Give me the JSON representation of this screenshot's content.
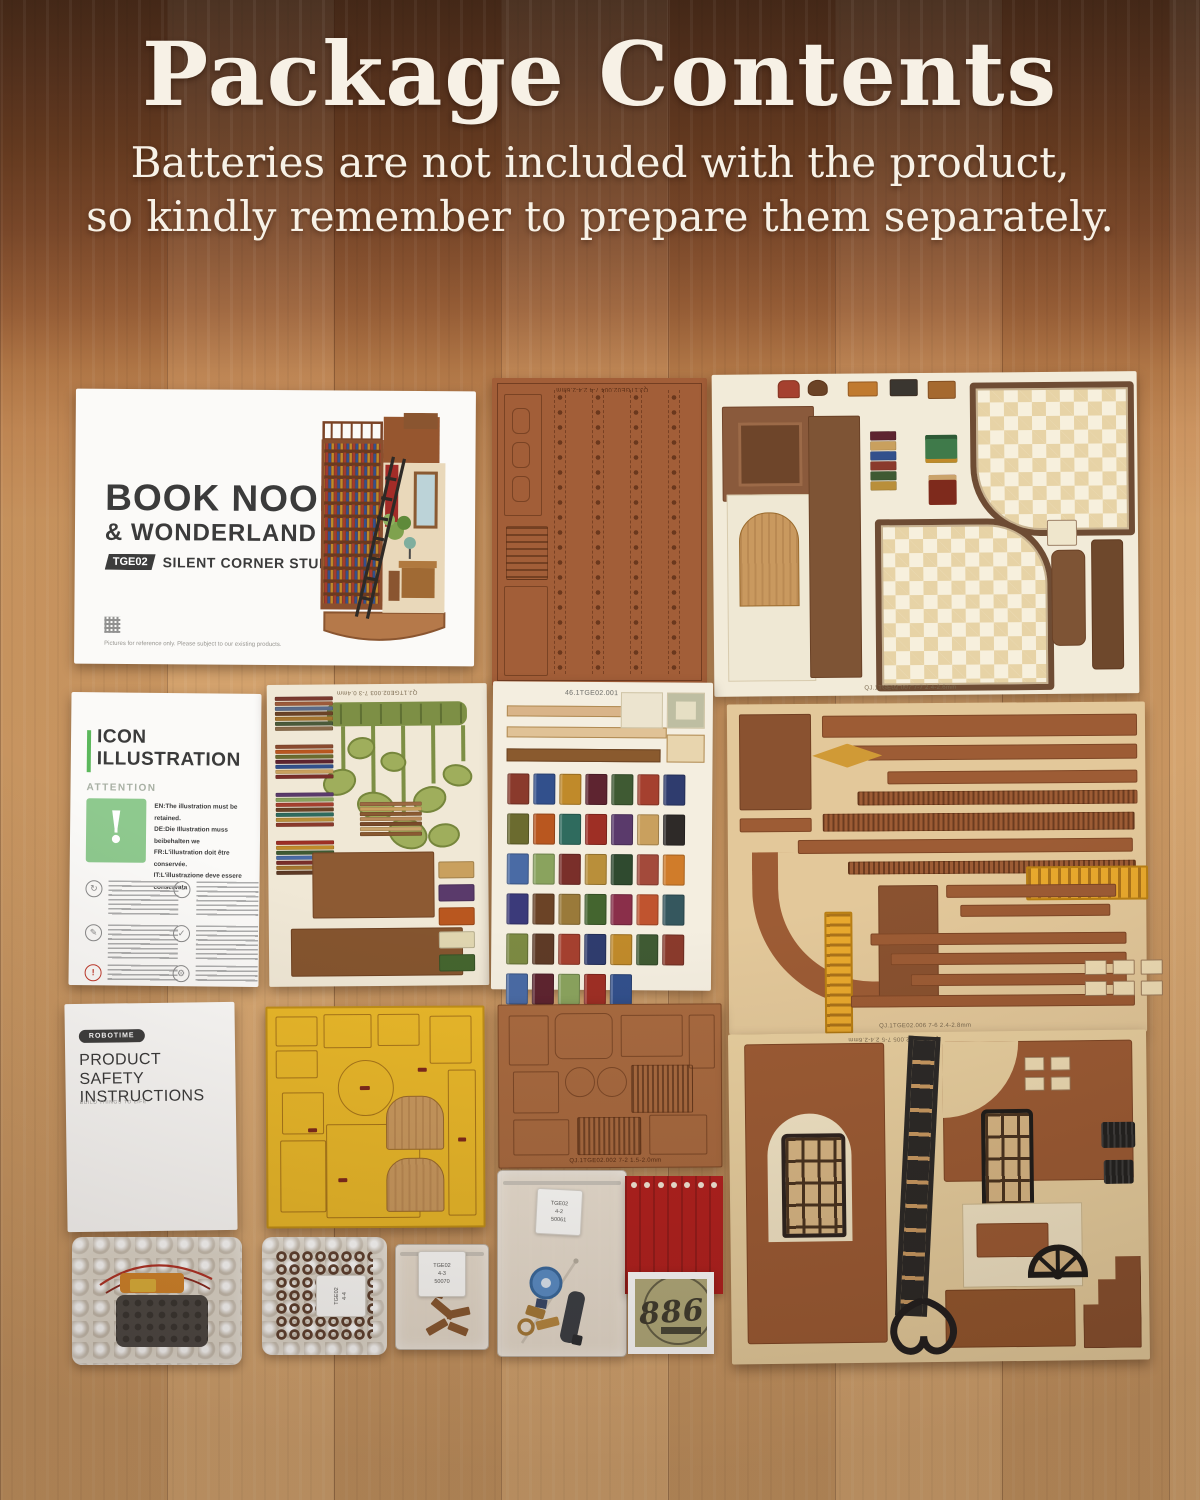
{
  "header": {
    "title": "Package Contents",
    "subtitle_line1": "Batteries are not included with the product,",
    "subtitle_line2": "so kindly remember to prepare them separately."
  },
  "booklet": {
    "title_line1": "BOOK NOOK",
    "title_line2": "& WONDERLAND",
    "model_badge": "TGE02",
    "subtitle": "SILENT CORNER STUDY",
    "fine_print": "Pictures for reference only. Please subject to our existing products."
  },
  "icon_sheet": {
    "title_line1": "ICON",
    "title_line2": "ILLUSTRATION",
    "attention_label": "ATTENTION",
    "attention_mark": "!",
    "notes": [
      "EN:The illustration must be retained.",
      "DE:Die Illustration muss beibehalten we",
      "FR:L'illustration doit être conservée.",
      "IT:L'illustrazione deve essere conservata"
    ],
    "icon_glyphs": {
      "perspective": "↻",
      "tips": "✎",
      "special": "!",
      "glue": "◔",
      "check": "✓",
      "gears": "⚙"
    }
  },
  "safety_sheet": {
    "brand": "ROBOTIME",
    "title_line1": "PRODUCT",
    "title_line2": "SAFETY INSTRUCTIONS",
    "tagline": "BUILD THINGS TO LIFE"
  },
  "sheet_labels": {
    "top_mid": "QJ.1TGE02.004 7-4 2.4-2.6mm",
    "top_right": "QJ.1TGE02.007 7-7 2.4-2.6mm",
    "plant": "QJ.1TGE02.003 7-3 0.4mm",
    "book_stickers": "46.1TGE02.001",
    "mid_right": "QJ.1TGE02.006 7-6 2.4-2.8mm",
    "small_brown": "QJ.1TGE02.002 7-2 1.5-2.0mm",
    "bottom_right": "QJ.1TGE02.005 7-5 2.4-2.6mm"
  },
  "bags": {
    "bag2_label_lines": [
      "TGE02",
      "4-4"
    ],
    "bag3_label_lines": [
      "TGE02",
      "4-3",
      "50070"
    ],
    "bag4_label_lines": [
      "TGE02",
      "4-2",
      "50061"
    ]
  },
  "sticker": {
    "number": "886"
  },
  "colors": {
    "wood_light": "#d2a069",
    "wood_dark": "#3f2516",
    "sheet_brown": "#a25e38",
    "sheet_tan": "#e3c89a",
    "sheet_cream": "#f2ebd9",
    "yellow_sheet": "#e9b82a",
    "railing_gold": "#e9a92d",
    "fabric_red": "#b2211f",
    "attention_green": "#8ec98e",
    "badge_dark": "#3c3c3c",
    "ladder_black": "#2c2a28"
  },
  "books": {
    "palette": [
      "#8a3a2c",
      "#32508c",
      "#c08a2a",
      "#5e2430",
      "#3f5a33",
      "#a5402f",
      "#2f3c6e",
      "#6b6b2f",
      "#b9571f",
      "#2f6b5e",
      "#9e2f25",
      "#5a3a6b",
      "#c9a05e",
      "#2e2a28",
      "#4a6ba5",
      "#8aa35e",
      "#7a2f2a",
      "#b98f3a",
      "#2f4a2f",
      "#a34a3b",
      "#d07c2a",
      "#3b3a7a",
      "#6b4326",
      "#9a7a3a",
      "#44652f",
      "#8a2f4a",
      "#c0542f",
      "#35575e",
      "#7c8a42",
      "#5e3a26",
      "#a5402f",
      "#2f3c6e",
      "#c08a2a",
      "#3f5a33",
      "#8a3a2c",
      "#4a6ba5",
      "#5e2430",
      "#8aa35e",
      "#9e2f25",
      "#32508c"
    ]
  },
  "stacks": {
    "s1": [
      "#7a3a2f",
      "#9c5a3a",
      "#5a6b8a",
      "#6b4326",
      "#a5752f",
      "#4a5a3a",
      "#8a6b4a"
    ],
    "s2": [
      "#8a4a2f",
      "#b9571f",
      "#6b6b2f",
      "#5e2430",
      "#32508c",
      "#c9a05e",
      "#7a2f2a"
    ],
    "s3": [
      "#5a3a6b",
      "#8aa35e",
      "#a5402f",
      "#6b4326",
      "#2f6b5e",
      "#b98f3a",
      "#8a3a2c"
    ],
    "s4": [
      "#9e2f25",
      "#c08a2a",
      "#3f5a33",
      "#4a6ba5",
      "#7a2f2a",
      "#a5752f",
      "#5e3a26"
    ],
    "s5": [
      "#6b4326",
      "#8a3a2c",
      "#2f3c6e",
      "#c9a05e",
      "#44652f",
      "#9c5a3a",
      "#5e2430"
    ],
    "s6": [
      "#9c6a42",
      "#c9a05e",
      "#8a5a32",
      "#b98a5a",
      "#7a4a2a",
      "#caa36b",
      "#8a5a32"
    ]
  },
  "plant_chips": [
    "#c9a05e",
    "#5a3a6b",
    "#b9571f",
    "#e0d6b0",
    "#44652f"
  ]
}
